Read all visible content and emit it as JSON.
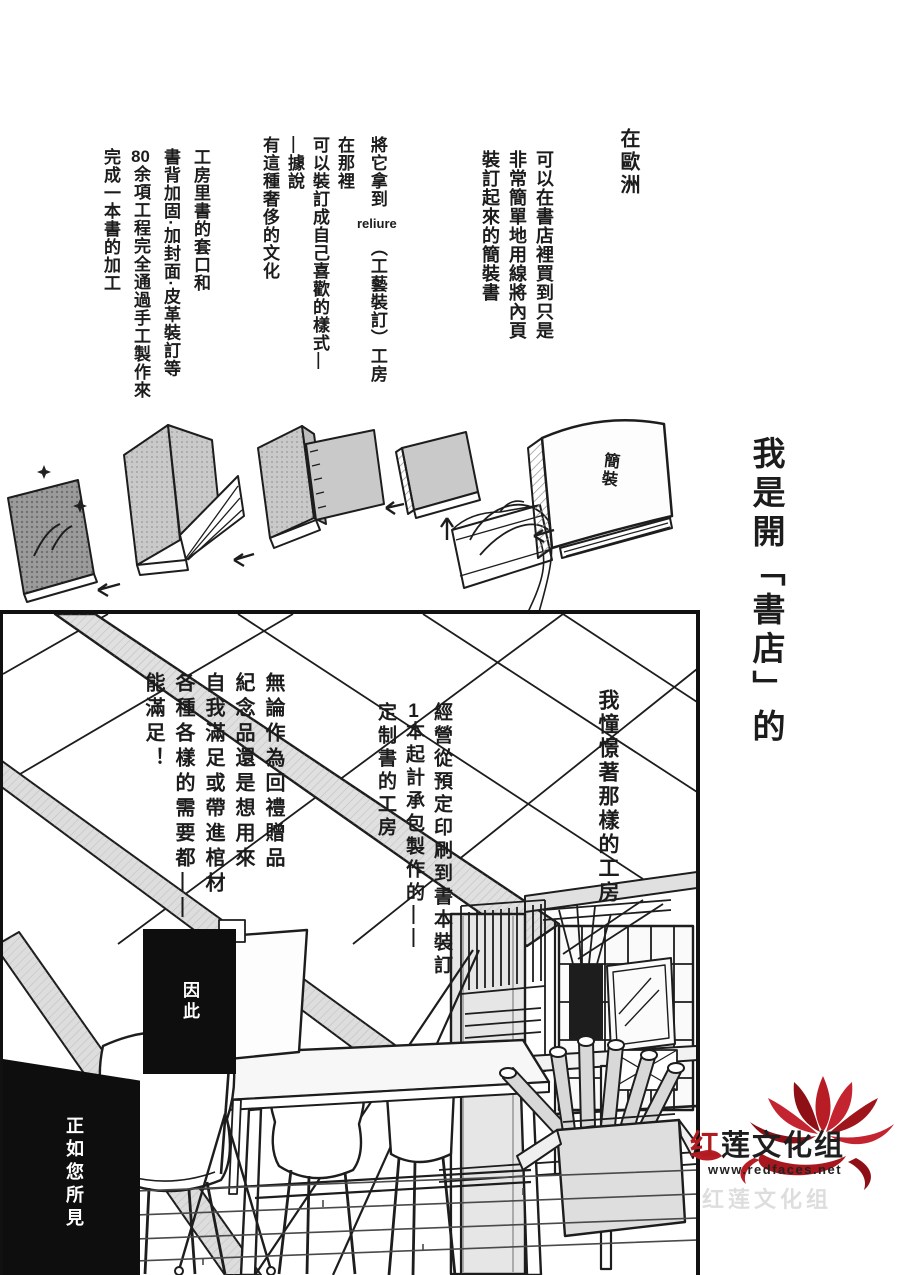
{
  "page": {
    "bg": "#ffffff",
    "ink": "#1c1c1c"
  },
  "top_section": {
    "intro": "在歐洲",
    "simple_binding": {
      "col1": "可以在書店裡買到只是",
      "col2": "非常簡單地用線將內頁",
      "col3": "裝訂起來的簡裝書"
    },
    "reliure": {
      "col1_pre": "將它拿到",
      "col1_word": "reliure",
      "col1_post": "（工藝裝訂）工房",
      "col2": "在那裡",
      "col3": "可以裝訂成自己喜歡的樣式—",
      "col4": "—據說",
      "col5": "有這種奢侈的文化"
    },
    "handcraft": {
      "col1": "工房里書的套口和",
      "col2": "書背加固·加封面·皮革裝訂等",
      "col3_num": "80",
      "col3_rest": "余項工程完全通過手工製作來",
      "col4": "完成一本書的加工"
    },
    "book_label": "簡裝"
  },
  "side_margin": {
    "narration": "我是開「書店」的"
  },
  "workshop_panel": {
    "admire": "我憧憬著那樣的工房",
    "custom_books": {
      "col1": "經營從預定印刷到書本裝訂",
      "col2_num": "1",
      "col2_rest": "本起計承包製作的——",
      "col3": "定制書的工房"
    },
    "uses": {
      "col1": "無論作為回禮贈品",
      "col2": "紀念品還是想用來",
      "col3": "自我滿足或帶進棺材",
      "col4": "各種各樣的需要都——",
      "col5": "能滿足！"
    },
    "therefore": "因此",
    "as_you_see": "正如您所見"
  },
  "scanlation_logo": {
    "name_red": "红",
    "name_black": "莲文化组",
    "url": "www.redfaces.net",
    "color_red": "#b01b1f",
    "color_dark_red": "#8e1016",
    "color_bright_red": "#c32430"
  }
}
